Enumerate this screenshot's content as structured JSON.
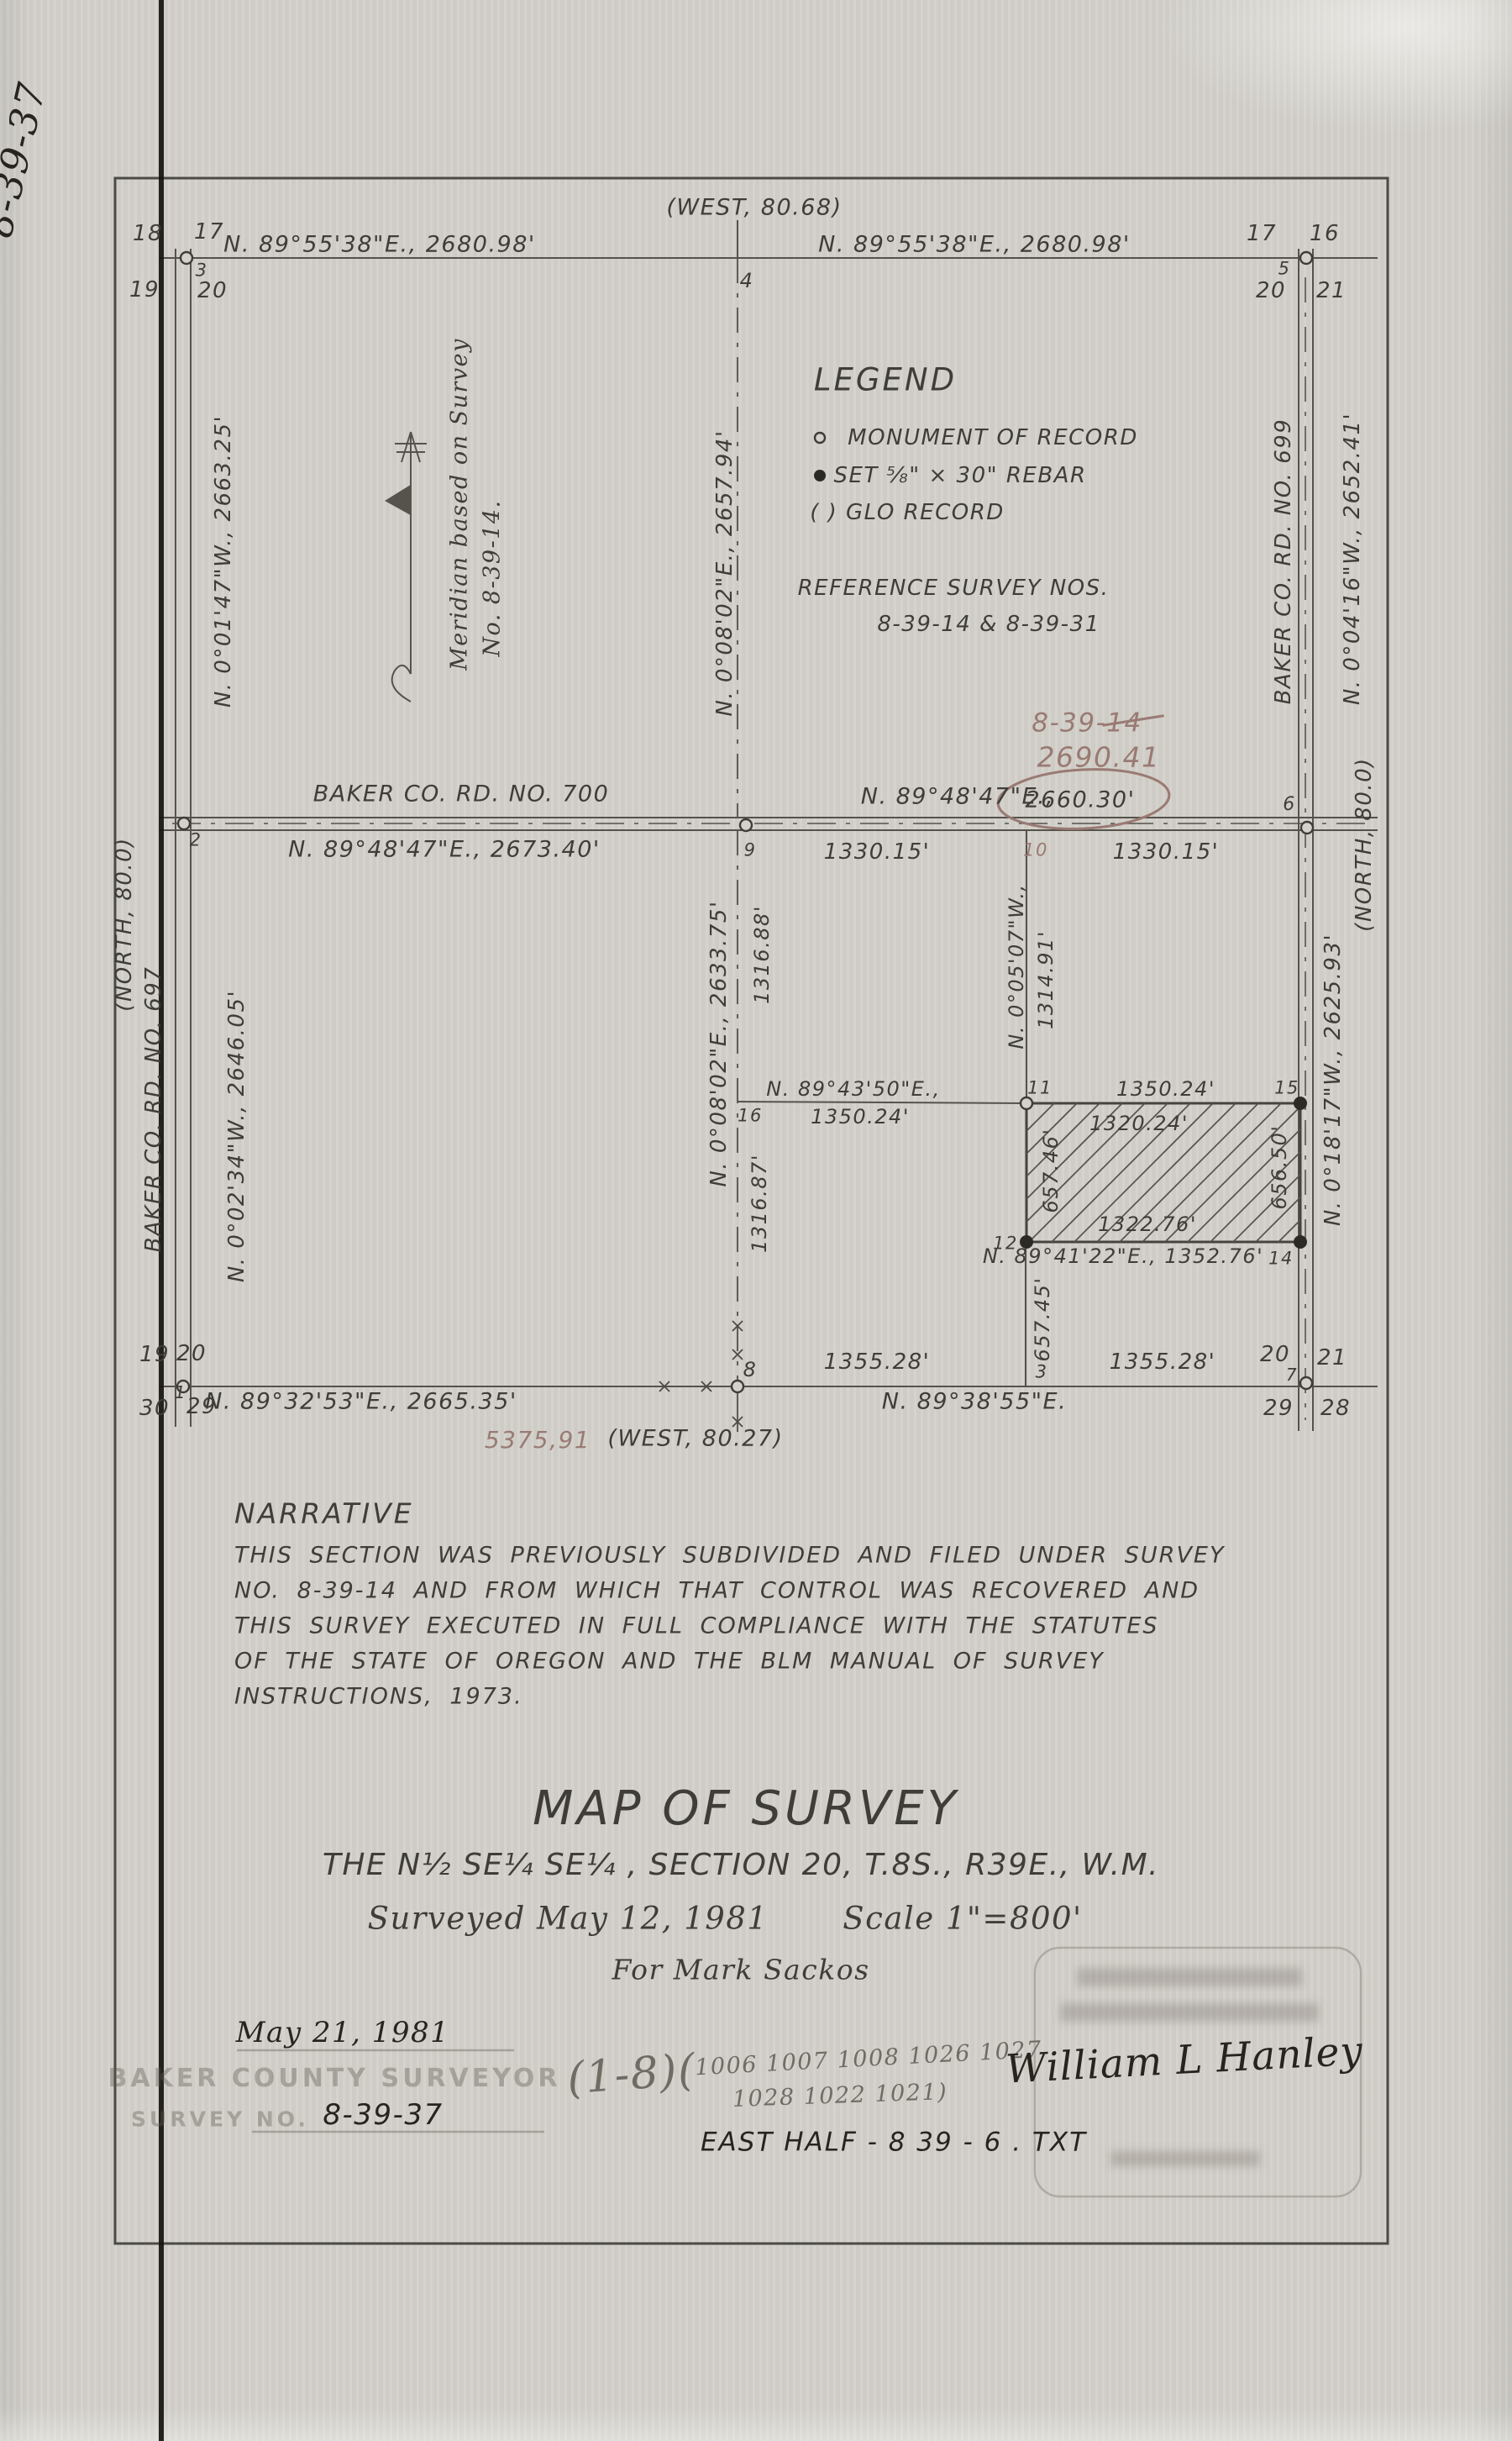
{
  "margin_note": "8-39-37",
  "map": {
    "top": {
      "glo_west": "(WEST, 80.68)",
      "bearing_left": "N. 89°55'38\"E., 2680.98'",
      "bearing_right": "N. 89°55'38\"E., 2680.98'",
      "sec_18": "18",
      "sec_17_left": "17",
      "sec_19": "19",
      "sec_20_left": "20",
      "pt_3": "3",
      "pt_4": "4",
      "sec_17_right": "17",
      "sec_16": "16",
      "sec_20_right": "20",
      "sec_21": "21",
      "pt_5": "5"
    },
    "left": {
      "bearing_upper": "N. 0°01'47\"W., 2663.25'",
      "glo_north": "(NORTH, 80.0)",
      "road": "BAKER CO. RD. NO. 697",
      "bearing_lower": "N. 0°02'34\"W., 2646.05'"
    },
    "meridian": {
      "line1": "Meridian based on Survey",
      "line2": "No. 8-39-14."
    },
    "right": {
      "road": "BAKER CO. RD. NO. 699",
      "bearing_upper": "N. 0°04'16\"W., 2652.41'",
      "glo_north": "(NORTH, 80.0)",
      "bearing_lower": "N. 0°18'17\"W., 2625.93'"
    },
    "center": {
      "bearing_upper": "N. 0°08'02\"E., 2657.94'",
      "bearing_lower": "N. 0°08'02\"E., 2633.75'",
      "dist_upper": "1316.88'",
      "dist_lower": "1316.87'",
      "pt_16": "16",
      "bearing_quarter": "N. 89°43'50\"E.,",
      "dist_quarter": "1350.24'"
    },
    "legend": {
      "title": "LEGEND",
      "item_monument": "MONUMENT OF RECORD",
      "item_rebar": "SET ⅝\" × 30\" REBAR",
      "item_glo": "( ) GLO RECORD",
      "ref_heading": "REFERENCE SURVEY NOS.",
      "ref_numbers": "8-39-14 & 8-39-31"
    },
    "red_notes": {
      "survey_no": "8-39-14",
      "added_dist": "2690.41",
      "total_dist": "5375,91",
      "pt_10": "10"
    },
    "road700": {
      "name": "BAKER CO. RD. NO. 700",
      "bearing_record": "N. 89°48'47\"E.,",
      "dist_record": "2660.30'",
      "bearing_measured": "N. 89°48'47\"E., 2673.40'",
      "dist_half_left": "1330.15'",
      "dist_half_right": "1330.15'",
      "pt_2": "2",
      "pt_9": "9",
      "pt_6": "6"
    },
    "parcel": {
      "bearing_west_line": "N. 0°05'07\"W.,",
      "dist_west_line": "1314.91'",
      "pt_11": "11",
      "pt_15": "15",
      "pt_12": "12",
      "pt_14": "14",
      "pt_3": "3",
      "dist_north": "1350.24'",
      "dist_north_inner": "1320.24'",
      "dist_west": "657.46'",
      "dist_east": "656.50'",
      "dist_south_inner": "1322.76'",
      "bearing_south": "N. 89°41'22\"E., 1352.76'",
      "dist_south_ext": "657.45'"
    },
    "bottom": {
      "dist_left": "1355.28'",
      "dist_right": "1355.28'",
      "pt_8": "8",
      "pt_1": "1",
      "pt_7": "7",
      "bearing_left": "N. 89°32'53\"E., 2665.35'",
      "bearing_right": "N. 89°38'55\"E.",
      "glo_west": "(WEST, 80.27)",
      "sec_19": "19",
      "sec_20_left": "20",
      "sec_29_left": "29",
      "sec_30": "30",
      "sec_20_right": "20",
      "sec_21": "21",
      "sec_29_right": "29",
      "sec_28": "28"
    }
  },
  "narrative": {
    "title": "NARRATIVE",
    "lines": [
      "THIS SECTION WAS PREVIOUSLY SUBDIVIDED AND FILED UNDER SURVEY",
      "NO. 8-39-14 AND FROM WHICH THAT CONTROL WAS RECOVERED AND",
      "THIS SURVEY EXECUTED IN FULL COMPLIANCE WITH THE STATUTES",
      "OF THE STATE OF OREGON AND THE BLM MANUAL OF SURVEY",
      "INSTRUCTIONS, 1973."
    ]
  },
  "title_block": {
    "title": "MAP OF SURVEY",
    "subtitle": "THE N½ SE¼ SE¼ , SECTION 20, T.8S., R39E., W.M.",
    "surveyed": "Surveyed May 12, 1981",
    "scale": "Scale 1\"=800'",
    "client": "For Mark Sackos"
  },
  "footer": {
    "filed_date": "May 21, 1981",
    "stamp_office": "BAKER COUNTY SURVEYOR",
    "stamp_survey_no_label": "SURVEY NO.",
    "survey_no": "8-39-37",
    "pencil_prefix": "(1-8)(",
    "pencil_row1": "1006 1007 1008 1026 1027",
    "pencil_row2": "1028 1022 1021)",
    "signature": "William L Hanley",
    "file_note": "EAST HALF - 8 39 - 6 . TXT"
  }
}
